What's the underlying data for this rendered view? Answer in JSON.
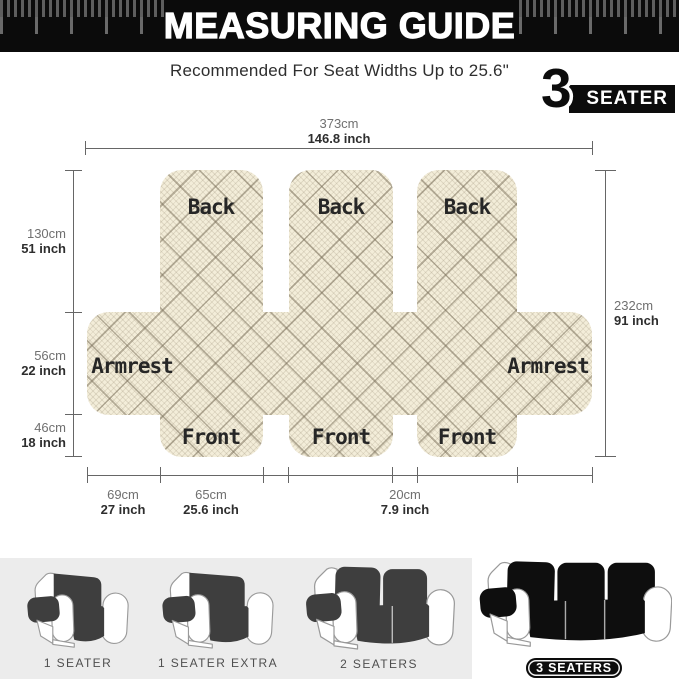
{
  "header": {
    "title": "MEASURING GUIDE",
    "subtitle": "Recommended For Seat Widths Up to 25.6\"",
    "badge_number": "3",
    "badge_label": "SEATER"
  },
  "diagram": {
    "labels": {
      "back": "Back",
      "front": "Front",
      "armrest": "Armrest"
    },
    "dim_top": {
      "cm": "373cm",
      "inch": "146.8 inch"
    },
    "dim_right": {
      "cm": "232cm",
      "inch": "91 inch"
    },
    "dim_left": [
      {
        "cm": "130cm",
        "inch": "51 inch"
      },
      {
        "cm": "56cm",
        "inch": "22 inch"
      },
      {
        "cm": "46cm",
        "inch": "18 inch"
      }
    ],
    "dim_bottom": [
      {
        "cm": "69cm",
        "inch": "27 inch"
      },
      {
        "cm": "65cm",
        "inch": "25.6 inch"
      },
      {
        "cm": "20cm",
        "inch": "7.9 inch"
      }
    ],
    "colors": {
      "cover_fill": "#f3edd9",
      "pattern_line": "#7a6f5a",
      "dimension_line": "#666666",
      "banner_black": "#0b0b0b",
      "highlight_black": "#0c0c0c",
      "variants_band_gray": "#ececec"
    }
  },
  "variants": [
    {
      "label": "1 SEATER",
      "icon": "armchair-1-seater-icon",
      "highlighted": false
    },
    {
      "label": "1 SEATER EXTRA",
      "icon": "armchair-1-seater-extra-icon",
      "highlighted": false
    },
    {
      "label": "2 SEATERS",
      "icon": "sofa-2-seater-icon",
      "highlighted": false
    },
    {
      "label": "3 SEATERS",
      "icon": "sofa-3-seater-icon",
      "highlighted": true
    }
  ]
}
